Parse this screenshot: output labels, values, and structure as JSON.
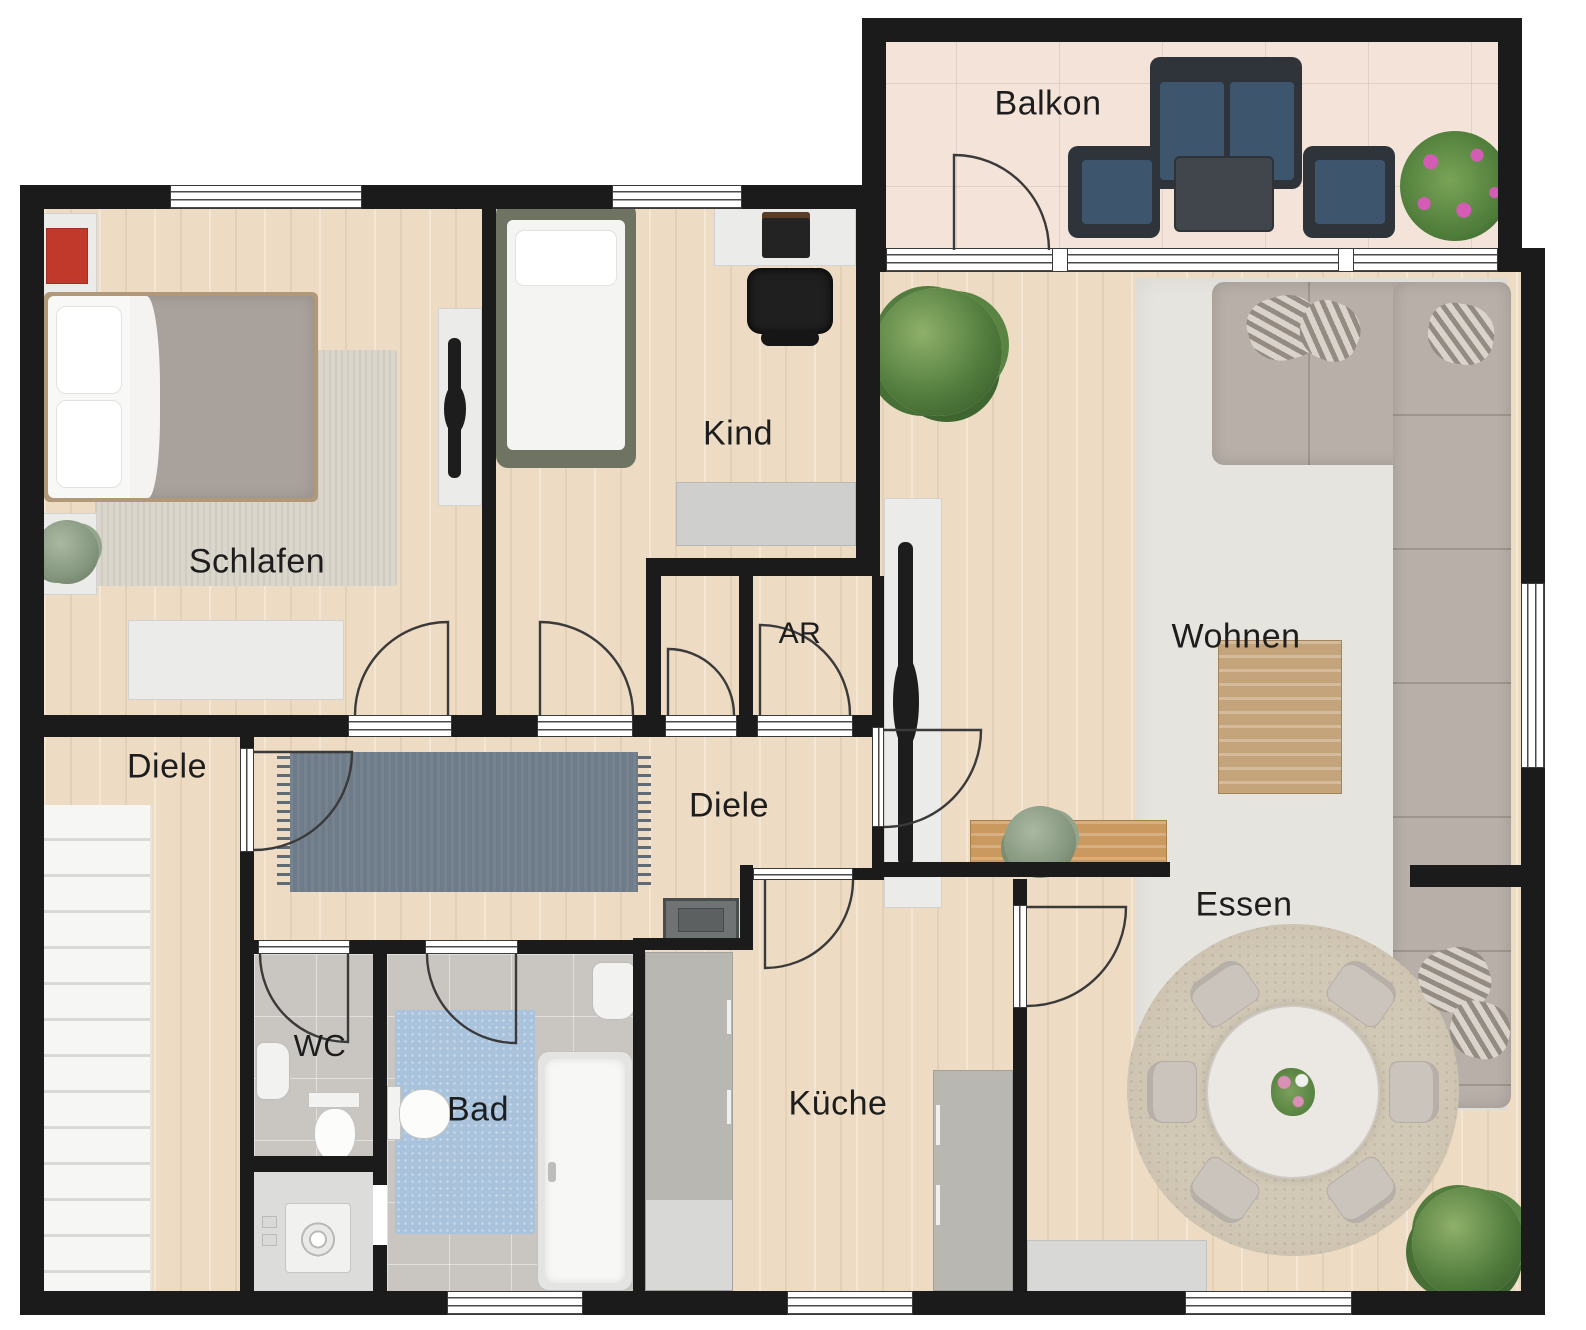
{
  "plan": {
    "type": "floor-plan",
    "language": "de",
    "rooms": [
      {
        "id": "balkon",
        "label": "Balkon"
      },
      {
        "id": "schlafen",
        "label": "Schlafen"
      },
      {
        "id": "kind",
        "label": "Kind"
      },
      {
        "id": "abstellraum",
        "label": "AR"
      },
      {
        "id": "diele-links",
        "label": "Diele"
      },
      {
        "id": "diele",
        "label": "Diele"
      },
      {
        "id": "wohnen",
        "label": "Wohnen"
      },
      {
        "id": "essen",
        "label": "Essen"
      },
      {
        "id": "wc",
        "label": "WC"
      },
      {
        "id": "bad",
        "label": "Bad"
      },
      {
        "id": "kueche",
        "label": "Küche"
      }
    ],
    "palette": {
      "wall": "#1b1b1b",
      "wood_floor": "#eddcc3",
      "balcony_tile": "#f4e3d9",
      "bath_tile": "#c9c5c1",
      "hall_rug": "#6e7b88",
      "bath_rug": "#a9c3dd",
      "bedroom_rug": "#dad6cc",
      "living_rug": "#e6e4df",
      "dining_rug": "#cfc5b2",
      "sofa": "#b8b0a8",
      "balcony_furniture": "#3d556d",
      "kitchen_counter": "#b9b7b2",
      "accent_red": "#c0392b",
      "plant_green": "#4c7a38",
      "label_text": "#1d1d1d"
    }
  }
}
